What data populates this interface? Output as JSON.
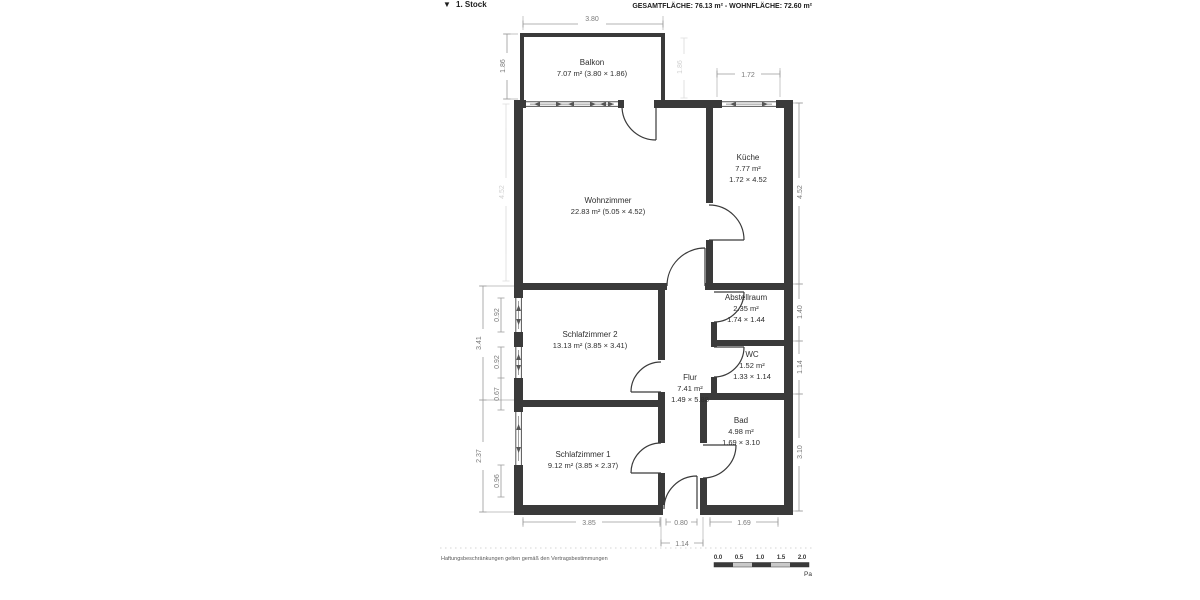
{
  "header": {
    "floor_marker": "▼",
    "floor_label": "1. Stock",
    "area_summary": "GESAMTFLÄCHE: 76.13 m² - WOHNFLÄCHE: 72.60 m²"
  },
  "rooms": {
    "balkon": {
      "name": "Balkon",
      "size": "7.07 m² (3.80 × 1.86)"
    },
    "wohnzimmer": {
      "name": "Wohnzimmer",
      "size": "22.83 m² (5.05 × 4.52)"
    },
    "kueche": {
      "name": "Küche",
      "area": "7.77 m²",
      "dims": "1.72 × 4.52"
    },
    "schlafzimmer2": {
      "name": "Schlafzimmer 2",
      "size": "13.13 m² (3.85 × 3.41)"
    },
    "abstellraum": {
      "name": "Abstellraum",
      "area": "2.35 m²",
      "dims": "1.74 × 1.44"
    },
    "wc": {
      "name": "WC",
      "area": "1.52 m²",
      "dims": "1.33 × 1.14"
    },
    "flur": {
      "name": "Flur",
      "area": "7.41 m²",
      "dims": "1.49 × 5.88"
    },
    "bad": {
      "name": "Bad",
      "area": "4.98 m²",
      "dims": "1.69 × 3.10"
    },
    "schlafzimmer1": {
      "name": "Schlafzimmer 1",
      "size": "9.12 m² (3.85 × 2.37)"
    }
  },
  "dimensions": {
    "top_balkon": "3.80",
    "top_kueche": "1.72",
    "left_balkon": "1.86",
    "left_wohnzimmer": "4.52",
    "right_balkon": "1.86",
    "left_sz2_outer": "3.41",
    "left_sz2_win1": "0.92",
    "left_sz2_win2": "0.92",
    "left_sz2_pier": "0.67",
    "left_sz1_outer": "2.37",
    "left_sz1_win": "0.96",
    "right_kueche": "4.52",
    "right_abstellraum": "1.40",
    "right_wc": "1.14",
    "right_bad": "3.10",
    "bottom_sz1": "3.85",
    "bottom_door": "0.80",
    "bottom_flur": "1.14",
    "bottom_bad": "1.69"
  },
  "footer": {
    "disclaimer": "Haftungsbeschränkungen gelten gemäß den Vertragsbestimmungen",
    "scale_labels": [
      "0.0",
      "0.5",
      "1.0",
      "1.5",
      "2.0"
    ],
    "page_hint": "Pa"
  },
  "colors": {
    "wall": "#3a3a3a",
    "dimension": "#9a9a9a",
    "text": "#2e2e2e",
    "background": "#ffffff"
  }
}
